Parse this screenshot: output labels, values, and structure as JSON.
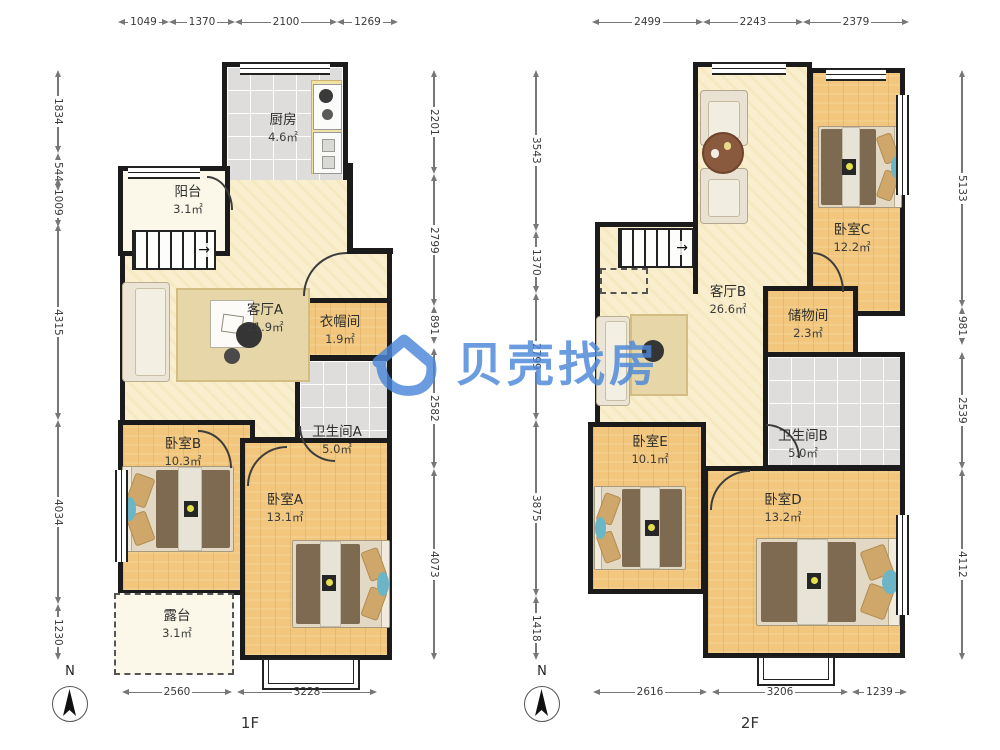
{
  "watermark": {
    "brand": "贝壳找房",
    "color": "#4a87d9"
  },
  "icons": {
    "stairs_arrow": "→"
  },
  "floor1": {
    "label": "1F",
    "compass_label": "N",
    "rooms": {
      "kitchen": {
        "name": "厨房",
        "area": "4.6㎡"
      },
      "balcony": {
        "name": "阳台",
        "area": "3.1㎡"
      },
      "living": {
        "name": "客厅A",
        "area": "21.9㎡"
      },
      "cloakroom": {
        "name": "衣帽间",
        "area": "1.9㎡"
      },
      "bathroomA": {
        "name": "卫生间A",
        "area": "5.0㎡"
      },
      "bedroomB": {
        "name": "卧室B",
        "area": "10.3㎡"
      },
      "bedroomA": {
        "name": "卧室A",
        "area": "13.1㎡"
      },
      "terrace": {
        "name": "露台",
        "area": "3.1㎡"
      }
    },
    "dims": {
      "top": [
        "1049",
        "1370",
        "2100",
        "1269"
      ],
      "left": [
        "1834",
        "544",
        "1009",
        "4315",
        "4034",
        "1230"
      ],
      "right": [
        "2201",
        "2799",
        "891",
        "2582",
        "4073"
      ],
      "bottom": [
        "2560",
        "3228"
      ]
    }
  },
  "floor2": {
    "label": "2F",
    "compass_label": "N",
    "rooms": {
      "living": {
        "name": "客厅B",
        "area": "26.6㎡"
      },
      "bedroomC": {
        "name": "卧室C",
        "area": "12.2㎡"
      },
      "storage": {
        "name": "储物间",
        "area": "2.3㎡"
      },
      "bathroomB": {
        "name": "卫生间B",
        "area": "5.0㎡"
      },
      "bedroomE": {
        "name": "卧室E",
        "area": "10.1㎡"
      },
      "bedroomD": {
        "name": "卧室D",
        "area": "13.2㎡"
      }
    },
    "dims": {
      "top": [
        "2499",
        "2243",
        "2379"
      ],
      "left": [
        "3543",
        "1370",
        "2799",
        "3875",
        "1418"
      ],
      "right": [
        "5133",
        "981",
        "2539",
        "4112"
      ],
      "bottom": [
        "2616",
        "3206",
        "1239"
      ]
    }
  }
}
